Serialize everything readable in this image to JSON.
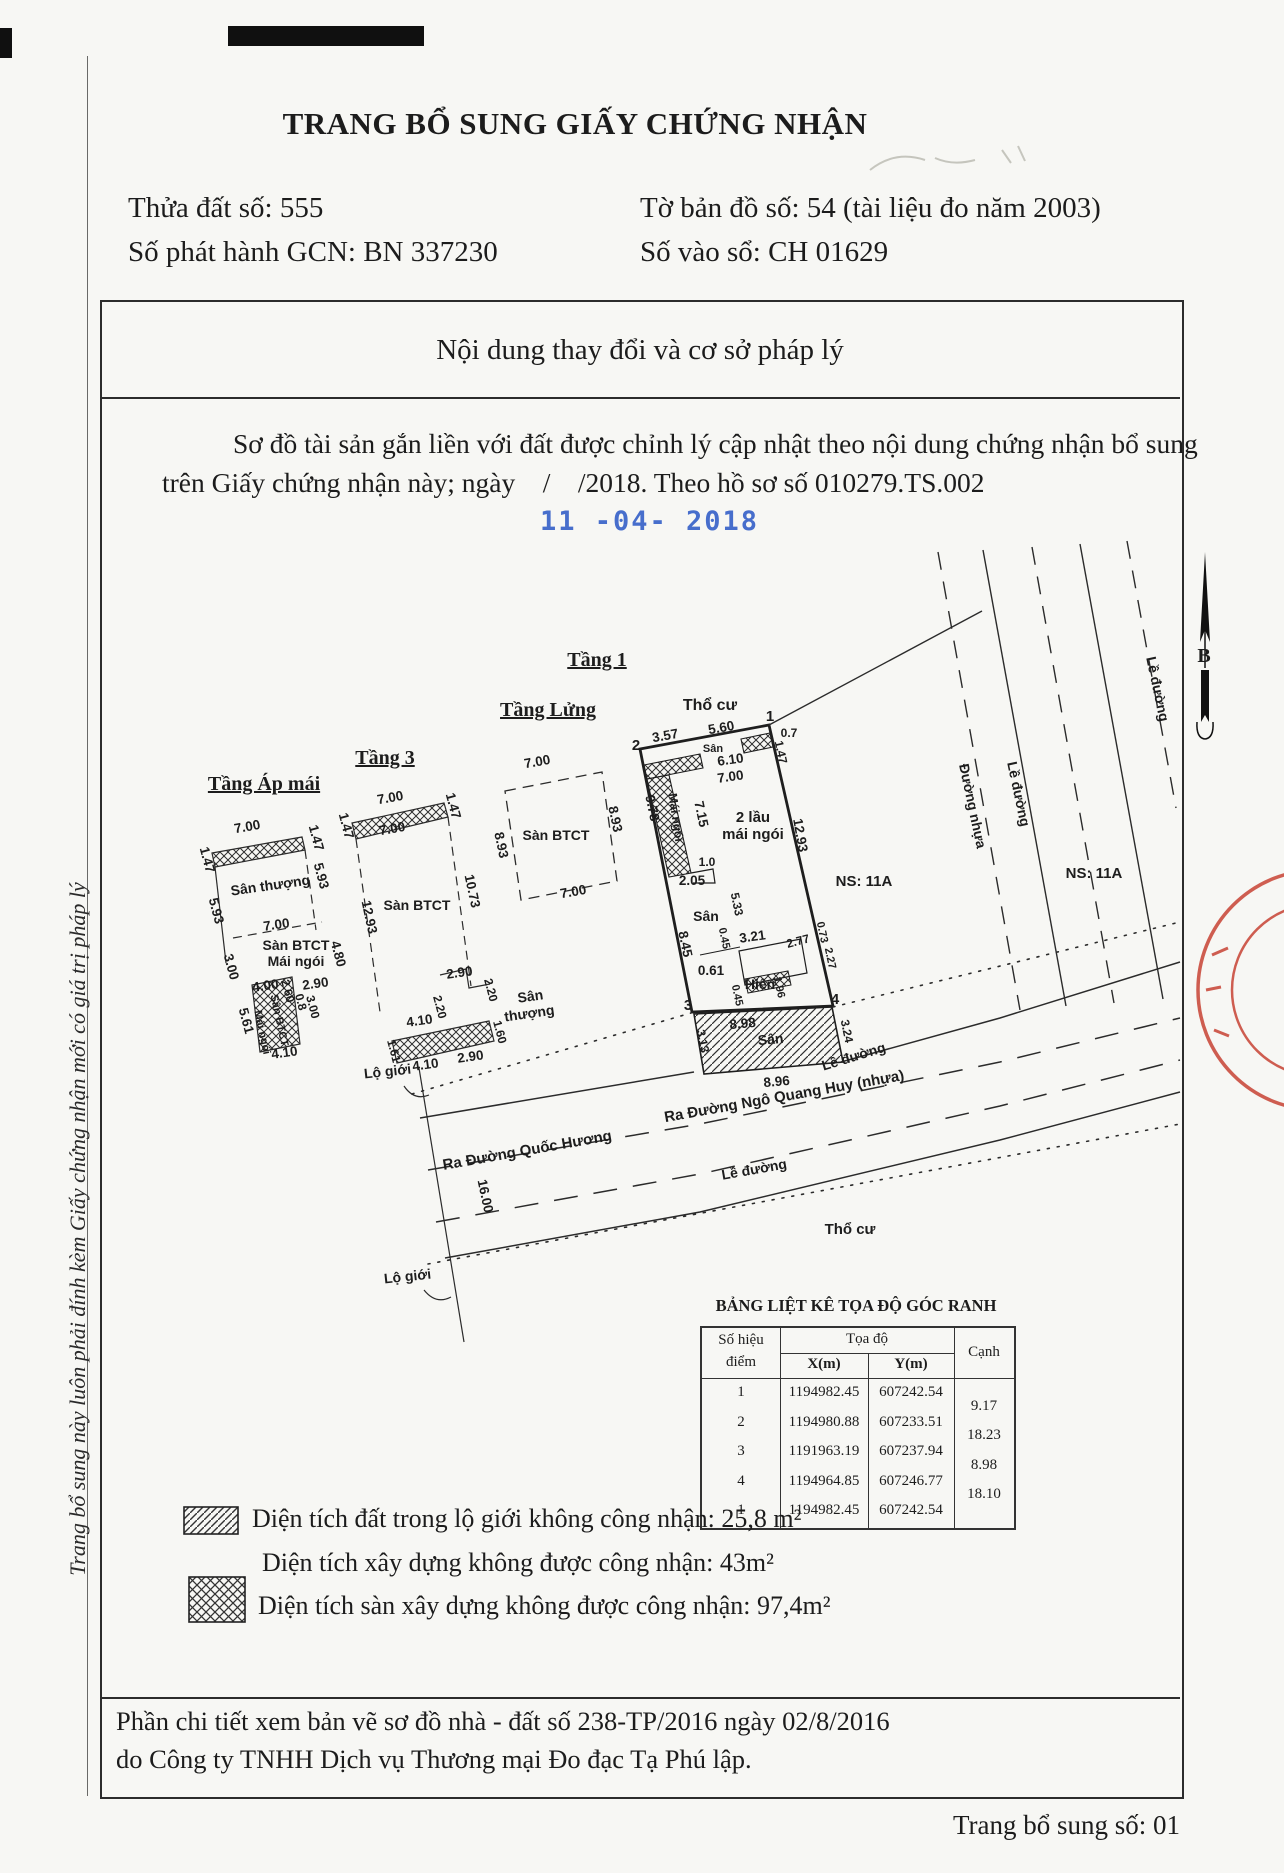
{
  "page": {
    "title": "TRANG BỔ SUNG GIẤY CHỨNG NHẬN",
    "footer": "Trang bổ sung số: 01",
    "side_text": "Trang bổ sung này luôn phải đính kèm Giấy chứng nhận mới có giá trị pháp lý"
  },
  "header_fields": {
    "parcel": "Thửa đất số: 555",
    "issue_no": "Số phát hành GCN: BN 337230",
    "map_sheet": "Tờ bản đồ số: 54 (tài liệu đo năm 2003)",
    "book_no": "Số vào sổ: CH 01629"
  },
  "content_box": {
    "heading": "Nội dung thay đổi và cơ sở pháp lý",
    "paragraph_line1": "Sơ đồ tài sản gắn liền với đất được chỉnh lý cập nhật theo nội dung chứng nhận bổ sung",
    "paragraph_line2": "trên Giấy chứng nhận này; ngày    /    /2018. Theo hồ sơ số 010279.TS.002",
    "date_stamp": "11 -04- 2018"
  },
  "coordinate_table": {
    "title": "BẢNG LIỆT KÊ TỌA ĐỘ GÓC RANH",
    "header": {
      "point_line1": "Số hiệu",
      "point_line2": "điểm",
      "coord": "Tọa độ",
      "x": "X(m)",
      "y": "Y(m)",
      "edge": "Cạnh"
    },
    "rows": [
      [
        "1",
        "1194982.45",
        "607242.54"
      ],
      [
        "2",
        "1194980.88",
        "607233.51"
      ],
      [
        "3",
        "1191963.19",
        "607237.94"
      ],
      [
        "4",
        "1194964.85",
        "607246.77"
      ],
      [
        "1",
        "1194982.45",
        "607242.54"
      ]
    ],
    "edges": [
      "9.17",
      "18.23",
      "8.98",
      "18.10"
    ]
  },
  "legend": {
    "item1": "Diện tích đất trong lộ giới không công nhận: 25,8 m²",
    "item2": "Diện tích xây dựng không được công nhận: 43m²",
    "item3": "Diện tích sàn xây dựng không được công nhận: 97,4m²"
  },
  "footer_note": {
    "line1": "Phần chi tiết xem bản vẽ sơ đồ nhà - đất số  238-TP/2016 ngày 02/8/2016",
    "line2": "do Công ty TNHH Dịch vụ Thương mại Đo đạc Tạ Phú lập."
  },
  "colors": {
    "ink": "#1c1c1c",
    "stamp_blue": "#3560c8",
    "stamp_red": "#c84334"
  },
  "drawing": {
    "north_label": "B",
    "labels": [
      {
        "t": "Tầng Áp mái",
        "x": 264,
        "y": 790,
        "s": 20,
        "b": 1,
        "u": 1,
        "f": "serif"
      },
      {
        "t": "Tầng 3",
        "x": 385,
        "y": 764,
        "s": 20,
        "b": 1,
        "u": 1,
        "f": "serif"
      },
      {
        "t": "Tầng Lửng",
        "x": 548,
        "y": 716,
        "s": 20,
        "b": 1,
        "u": 1,
        "f": "serif"
      },
      {
        "t": "Tầng 1",
        "x": 597,
        "y": 666,
        "s": 20,
        "b": 1,
        "u": 1,
        "f": "serif"
      },
      {
        "t": "7.00",
        "x": 248,
        "y": 831,
        "r": -10
      },
      {
        "t": "1.47",
        "x": 203,
        "y": 861,
        "r": 75
      },
      {
        "t": "1.47",
        "x": 312,
        "y": 839,
        "r": 75
      },
      {
        "t": "5.93",
        "x": 317,
        "y": 877,
        "r": 75
      },
      {
        "t": "Sân thượng",
        "x": 271,
        "y": 890,
        "r": -8,
        "s": 14
      },
      {
        "t": "5.93",
        "x": 212,
        "y": 912,
        "r": 75
      },
      {
        "t": "7.00",
        "x": 277,
        "y": 929,
        "r": -8
      },
      {
        "t": "Sàn BTCT",
        "x": 296,
        "y": 950,
        "s": 14
      },
      {
        "t": "Mái ngói",
        "x": 296,
        "y": 966,
        "s": 14
      },
      {
        "t": "4.80",
        "x": 334,
        "y": 955,
        "r": 75
      },
      {
        "t": "3.00",
        "x": 227,
        "y": 968,
        "r": 75
      },
      {
        "t": "4.00",
        "x": 266,
        "y": 990,
        "r": -8
      },
      {
        "t": "2.60",
        "x": 284,
        "y": 992,
        "r": 75,
        "s": 12
      },
      {
        "t": "2.90",
        "x": 316,
        "y": 988,
        "r": -8
      },
      {
        "t": "0.8",
        "x": 297,
        "y": 1003,
        "r": 75,
        "s": 12
      },
      {
        "t": "3.00",
        "x": 309,
        "y": 1008,
        "r": 75,
        "s": 12
      },
      {
        "t": "5.61",
        "x": 242,
        "y": 1022,
        "r": 75
      },
      {
        "t": "Sân BTCT",
        "x": 276,
        "y": 1021,
        "r": 78,
        "s": 11
      },
      {
        "t": "Mái ngói",
        "x": 259,
        "y": 1033,
        "r": 78,
        "s": 11
      },
      {
        "t": "4.10",
        "x": 285,
        "y": 1057,
        "r": -8
      },
      {
        "t": "7.00",
        "x": 391,
        "y": 802,
        "r": -10
      },
      {
        "t": "1.47",
        "x": 342,
        "y": 827,
        "r": 75
      },
      {
        "t": "1.47",
        "x": 449,
        "y": 807,
        "r": 75
      },
      {
        "t": "7.00",
        "x": 393,
        "y": 833,
        "r": -10
      },
      {
        "t": "12.93",
        "x": 365,
        "y": 918,
        "r": 78
      },
      {
        "t": "10.73",
        "x": 468,
        "y": 892,
        "r": 78
      },
      {
        "t": "Sàn BTCT",
        "x": 417,
        "y": 910,
        "s": 14
      },
      {
        "t": "2.90",
        "x": 460,
        "y": 977,
        "r": -8
      },
      {
        "t": "2.20",
        "x": 487,
        "y": 991,
        "r": 75,
        "s": 12
      },
      {
        "t": "2.20",
        "x": 436,
        "y": 1008,
        "r": 75,
        "s": 12
      },
      {
        "t": "Sân",
        "x": 531,
        "y": 1001,
        "r": -8,
        "s": 14
      },
      {
        "t": "thượng",
        "x": 530,
        "y": 1018,
        "r": -8,
        "s": 14
      },
      {
        "t": "4.10",
        "x": 420,
        "y": 1025,
        "r": -8
      },
      {
        "t": "1.60",
        "x": 496,
        "y": 1033,
        "r": 75,
        "s": 12
      },
      {
        "t": "1.61",
        "x": 390,
        "y": 1052,
        "r": 75,
        "s": 12
      },
      {
        "t": "4.10",
        "x": 426,
        "y": 1069,
        "r": -8
      },
      {
        "t": "2.90",
        "x": 471,
        "y": 1061,
        "r": -8
      },
      {
        "t": "7.00",
        "x": 538,
        "y": 766,
        "r": -10
      },
      {
        "t": "8.93",
        "x": 497,
        "y": 846,
        "r": 78
      },
      {
        "t": "8.93",
        "x": 611,
        "y": 820,
        "r": 78
      },
      {
        "t": "Sàn BTCT",
        "x": 556,
        "y": 840,
        "s": 14
      },
      {
        "t": "7.00",
        "x": 574,
        "y": 896,
        "r": -10
      },
      {
        "t": "Thổ cư",
        "x": 710,
        "y": 710,
        "s": 16
      },
      {
        "t": "3.57",
        "x": 666,
        "y": 740,
        "r": -10
      },
      {
        "t": "5.60",
        "x": 722,
        "y": 732,
        "r": -10
      },
      {
        "t": "Sân",
        "x": 713,
        "y": 752,
        "s": 11
      },
      {
        "t": "6.10",
        "x": 731,
        "y": 764,
        "r": -8
      },
      {
        "t": "7.00",
        "x": 731,
        "y": 781,
        "r": -8
      },
      {
        "t": "0.7",
        "x": 789,
        "y": 737,
        "s": 12
      },
      {
        "t": "1.47",
        "x": 777,
        "y": 753,
        "r": 78,
        "s": 12
      },
      {
        "t": "2",
        "x": 636,
        "y": 750,
        "s": 15,
        "b": 1
      },
      {
        "t": "1",
        "x": 770,
        "y": 721,
        "s": 15,
        "b": 1
      },
      {
        "t": "9.78",
        "x": 648,
        "y": 809,
        "r": 78
      },
      {
        "t": "Mái ngói",
        "x": 672,
        "y": 818,
        "r": 82,
        "s": 12
      },
      {
        "t": "7.15",
        "x": 697,
        "y": 815,
        "r": 78
      },
      {
        "t": "2 lầu",
        "x": 753,
        "y": 822,
        "s": 15
      },
      {
        "t": "mái ngói",
        "x": 753,
        "y": 839,
        "s": 15
      },
      {
        "t": "12.93",
        "x": 796,
        "y": 836,
        "r": 80
      },
      {
        "t": "1.0",
        "x": 707,
        "y": 866,
        "s": 12
      },
      {
        "t": "2.05",
        "x": 692,
        "y": 885
      },
      {
        "t": "Sân",
        "x": 706,
        "y": 921,
        "s": 14
      },
      {
        "t": "5.33",
        "x": 733,
        "y": 905,
        "r": 78,
        "s": 12
      },
      {
        "t": "8.45",
        "x": 681,
        "y": 945,
        "r": 78
      },
      {
        "t": "0.45",
        "x": 721,
        "y": 939,
        "r": 78,
        "s": 11
      },
      {
        "t": "3.21",
        "x": 753,
        "y": 941,
        "r": -8
      },
      {
        "t": "2.77",
        "x": 799,
        "y": 945,
        "r": -15,
        "s": 12
      },
      {
        "t": "0.73",
        "x": 819,
        "y": 933,
        "r": 78,
        "s": 11
      },
      {
        "t": "2.27",
        "x": 827,
        "y": 959,
        "r": 78,
        "s": 11
      },
      {
        "t": "0.61",
        "x": 711,
        "y": 975
      },
      {
        "t": "Hiên",
        "x": 760,
        "y": 989,
        "s": 14
      },
      {
        "t": "1.96",
        "x": 776,
        "y": 988,
        "r": 78,
        "s": 11
      },
      {
        "t": "0.45",
        "x": 734,
        "y": 996,
        "r": 78,
        "s": 11
      },
      {
        "t": "3",
        "x": 688,
        "y": 1010,
        "s": 15,
        "b": 1
      },
      {
        "t": "4",
        "x": 835,
        "y": 1004,
        "s": 15,
        "b": 1
      },
      {
        "t": "8.98",
        "x": 743,
        "y": 1028,
        "r": -5
      },
      {
        "t": "Sân",
        "x": 771,
        "y": 1044,
        "r": -5,
        "s": 14
      },
      {
        "t": "3.13",
        "x": 699,
        "y": 1042,
        "r": 78,
        "s": 12
      },
      {
        "t": "3.24",
        "x": 843,
        "y": 1032,
        "r": 78,
        "s": 12
      },
      {
        "t": "Lề đường",
        "x": 855,
        "y": 1061,
        "r": -17,
        "s": 14
      },
      {
        "t": "8.96",
        "x": 777,
        "y": 1086,
        "r": -5
      },
      {
        "t": "NS: 11A",
        "x": 864,
        "y": 886,
        "s": 15
      },
      {
        "t": "NS: 11A",
        "x": 1094,
        "y": 878,
        "s": 15
      },
      {
        "t": "Lề đường",
        "x": 1014,
        "y": 795,
        "r": 78,
        "s": 14
      },
      {
        "t": "Đường nhựa",
        "x": 968,
        "y": 807,
        "r": 78,
        "s": 14
      },
      {
        "t": "Lề đường",
        "x": 1153,
        "y": 690,
        "r": 78,
        "s": 14
      },
      {
        "t": "Lộ giới",
        "x": 388,
        "y": 1076,
        "r": -6,
        "s": 14
      },
      {
        "t": "Ra Đường Quốc Hương",
        "x": 528,
        "y": 1155,
        "r": -10,
        "s": 15
      },
      {
        "t": "Ra Đường Ngô Quang Huy (nhựa)",
        "x": 785,
        "y": 1101,
        "r": -10,
        "s": 15
      },
      {
        "t": "Lề đường",
        "x": 755,
        "y": 1174,
        "r": -10,
        "s": 14
      },
      {
        "t": "16.00",
        "x": 481,
        "y": 1197,
        "r": 78
      },
      {
        "t": "Thổ cư",
        "x": 850,
        "y": 1234,
        "s": 15
      },
      {
        "t": "Lộ giới",
        "x": 408,
        "y": 1281,
        "r": -6,
        "s": 14
      }
    ]
  }
}
